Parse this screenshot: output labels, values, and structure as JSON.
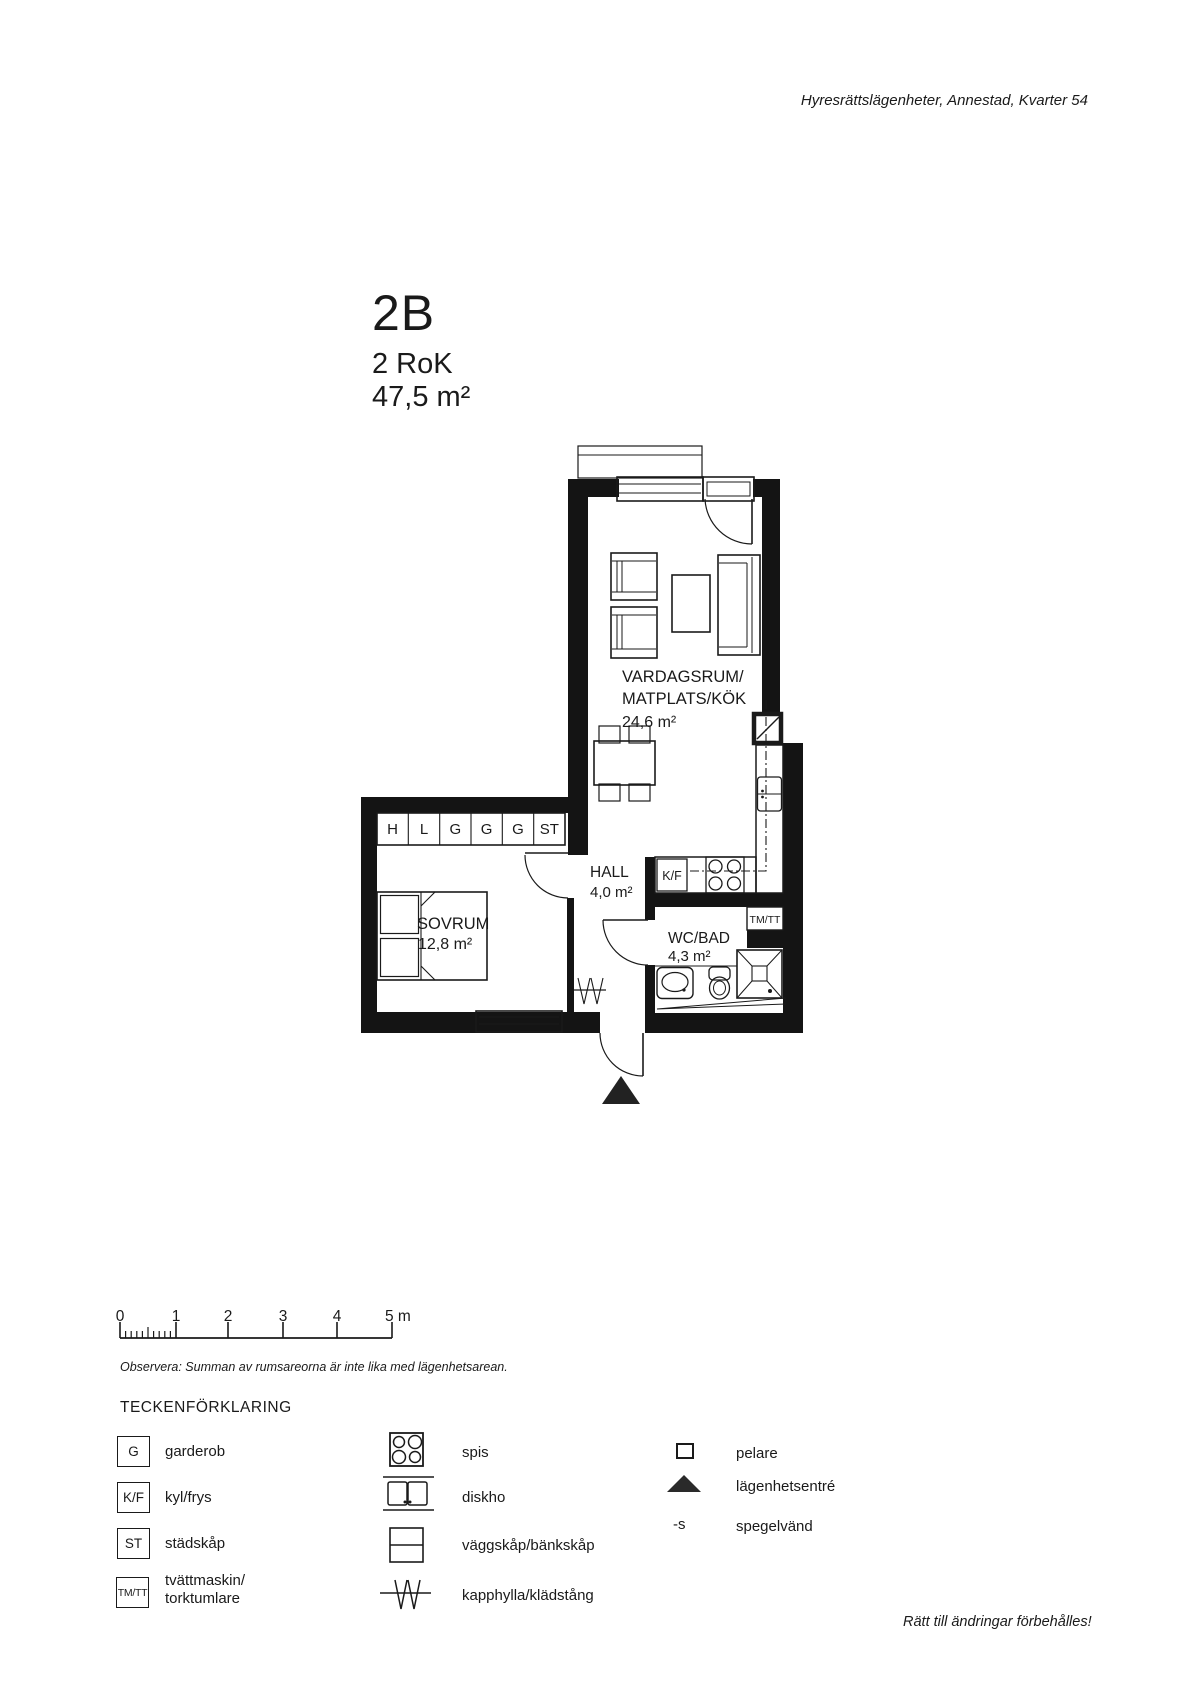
{
  "header": {
    "project_line": "Hyresrättslägenheter, Annestad, Kvarter 54"
  },
  "title": {
    "unit": "2B",
    "rooms": "2 RoK",
    "area": "47,5 m²"
  },
  "floorplan": {
    "living_room": {
      "name_line1": "VARDAGSRUM/",
      "name_line2": "MATPLATS/KÖK",
      "area": "24,6 m²"
    },
    "bedroom": {
      "name": "SOVRUM",
      "area": "12,8 m²"
    },
    "hall": {
      "name": "HALL",
      "area": "4,0 m²"
    },
    "bathroom": {
      "name": "WC/BAD",
      "area": "4,3 m²"
    },
    "closet_labels": [
      "H",
      "L",
      "G",
      "G",
      "G",
      "ST"
    ],
    "fridge_label": "K/F",
    "washer_label": "TM/TT"
  },
  "scalebar": {
    "tick_labels": [
      "0",
      "1",
      "2",
      "3",
      "4"
    ],
    "end_label": "5 m"
  },
  "note": "Observera: Summan av rumsareorna är inte lika med lägenhetsarean.",
  "legend": {
    "heading": "TECKENFÖRKLARING",
    "items_boxes": [
      {
        "symbol": "G",
        "label": "garderob"
      },
      {
        "symbol": "K/F",
        "label": "kyl/frys"
      },
      {
        "symbol": "ST",
        "label": "städskåp"
      },
      {
        "symbol": "TM/TT",
        "label_line1": "tvättmaskin/",
        "label_line2": "torktumlare"
      }
    ],
    "items_symbols": [
      {
        "icon": "stove-icon",
        "label": "spis"
      },
      {
        "icon": "sink-icon",
        "label": "diskho"
      },
      {
        "icon": "cabinet-icon",
        "label": "väggskåp/bänkskåp"
      },
      {
        "icon": "coatrack-icon",
        "label": "kapphylla/klädstång"
      }
    ],
    "items_misc": [
      {
        "icon": "column-icon",
        "label": "pelare"
      },
      {
        "icon": "entrance-icon",
        "label": "lägenhetsentré"
      },
      {
        "symbol": "-s",
        "label": "spegelvänd"
      }
    ]
  },
  "footer": {
    "disclaimer": "Rätt till ändringar förbehålles!"
  },
  "colors": {
    "ink": "#1a1a1a",
    "paper": "#ffffff"
  }
}
